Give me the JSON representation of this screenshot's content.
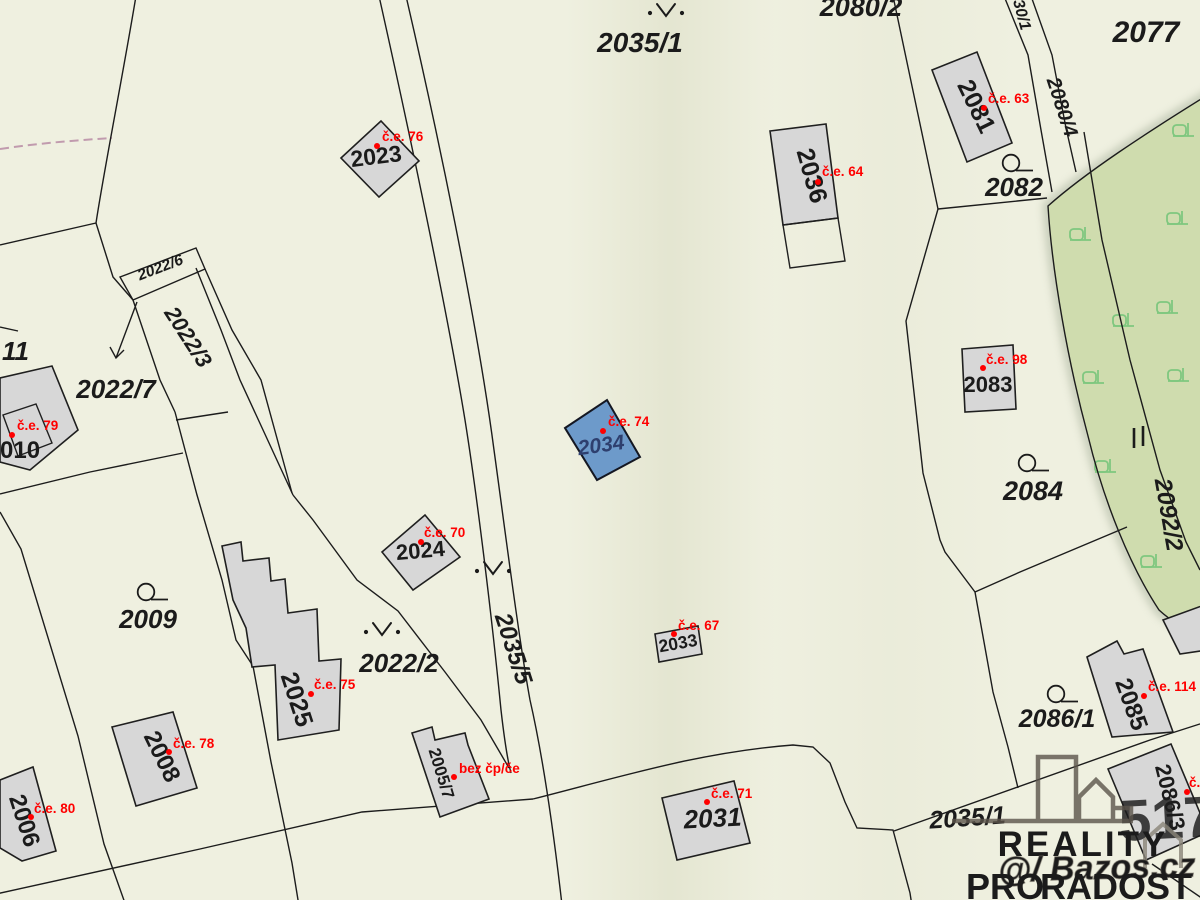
{
  "parcel_labels": {
    "p2035_1": "2035/1",
    "p2080_2": "2080/2",
    "p2077": "2077",
    "p30_1": "30/1",
    "p2080_4": "2080/4",
    "p2082": "2082",
    "p2084": "2084",
    "p2092_2": "2092/2",
    "p2086_1": "2086/1",
    "p2022_6": "2022/6",
    "p2022_3": "2022/3",
    "p2022_7": "2022/7",
    "p2022_2": "2022/2",
    "p2009": "2009",
    "p2011_partial": "11",
    "p2035_5": "2035/5",
    "p2035_1_south": "2035/1"
  },
  "building_labels": {
    "b2023": "2023",
    "b2024": "2024",
    "b2034": "2034",
    "b2036": "2036",
    "b2081": "2081",
    "b2083": "2083",
    "b2010_partial": "010",
    "b2025": "2025",
    "b2008": "2008",
    "b2006": "2006",
    "b2005_7": "2005/7",
    "b2033": "2033",
    "b2031": "2031",
    "b2085": "2085",
    "b2086_3": "2086/3"
  },
  "evidence_numbers": {
    "u76": "č.e. 76",
    "u63": "č.e. 63",
    "u64": "č.e. 64",
    "u79": "č.e. 79",
    "u98": "č.e. 98",
    "u74": "č.e. 74",
    "u70": "č.e. 70",
    "u75": "č.e. 75",
    "u78": "č.e. 78",
    "u80": "č.e. 80",
    "u67": "č.e. 67",
    "u71": "č.e. 71",
    "u114": "č.e. 114",
    "u_bez": "bez čp/če",
    "u_partial": "č."
  },
  "watermark": {
    "brand_line1": "REALITY",
    "brand_line2_a": "PRO",
    "brand_line2_b": "RADOST",
    "ghost_text": "@/ Bazos.cz",
    "red_number": "517"
  },
  "colors": {
    "background": "#eff0e0",
    "parcel_line": "#1c1c1c",
    "building_fill": "#d7d7d7",
    "selected_building_fill": "#6d9aca",
    "selected_building_label": "#2e3f6e",
    "forest_fill": "#cfdcae",
    "tree_icon": "#7fc77f",
    "evidence_red": "#ff0000",
    "watermark_dark": "#57514b",
    "watermark_tan": "#c9b394",
    "watermark_red": "#9b3530"
  }
}
